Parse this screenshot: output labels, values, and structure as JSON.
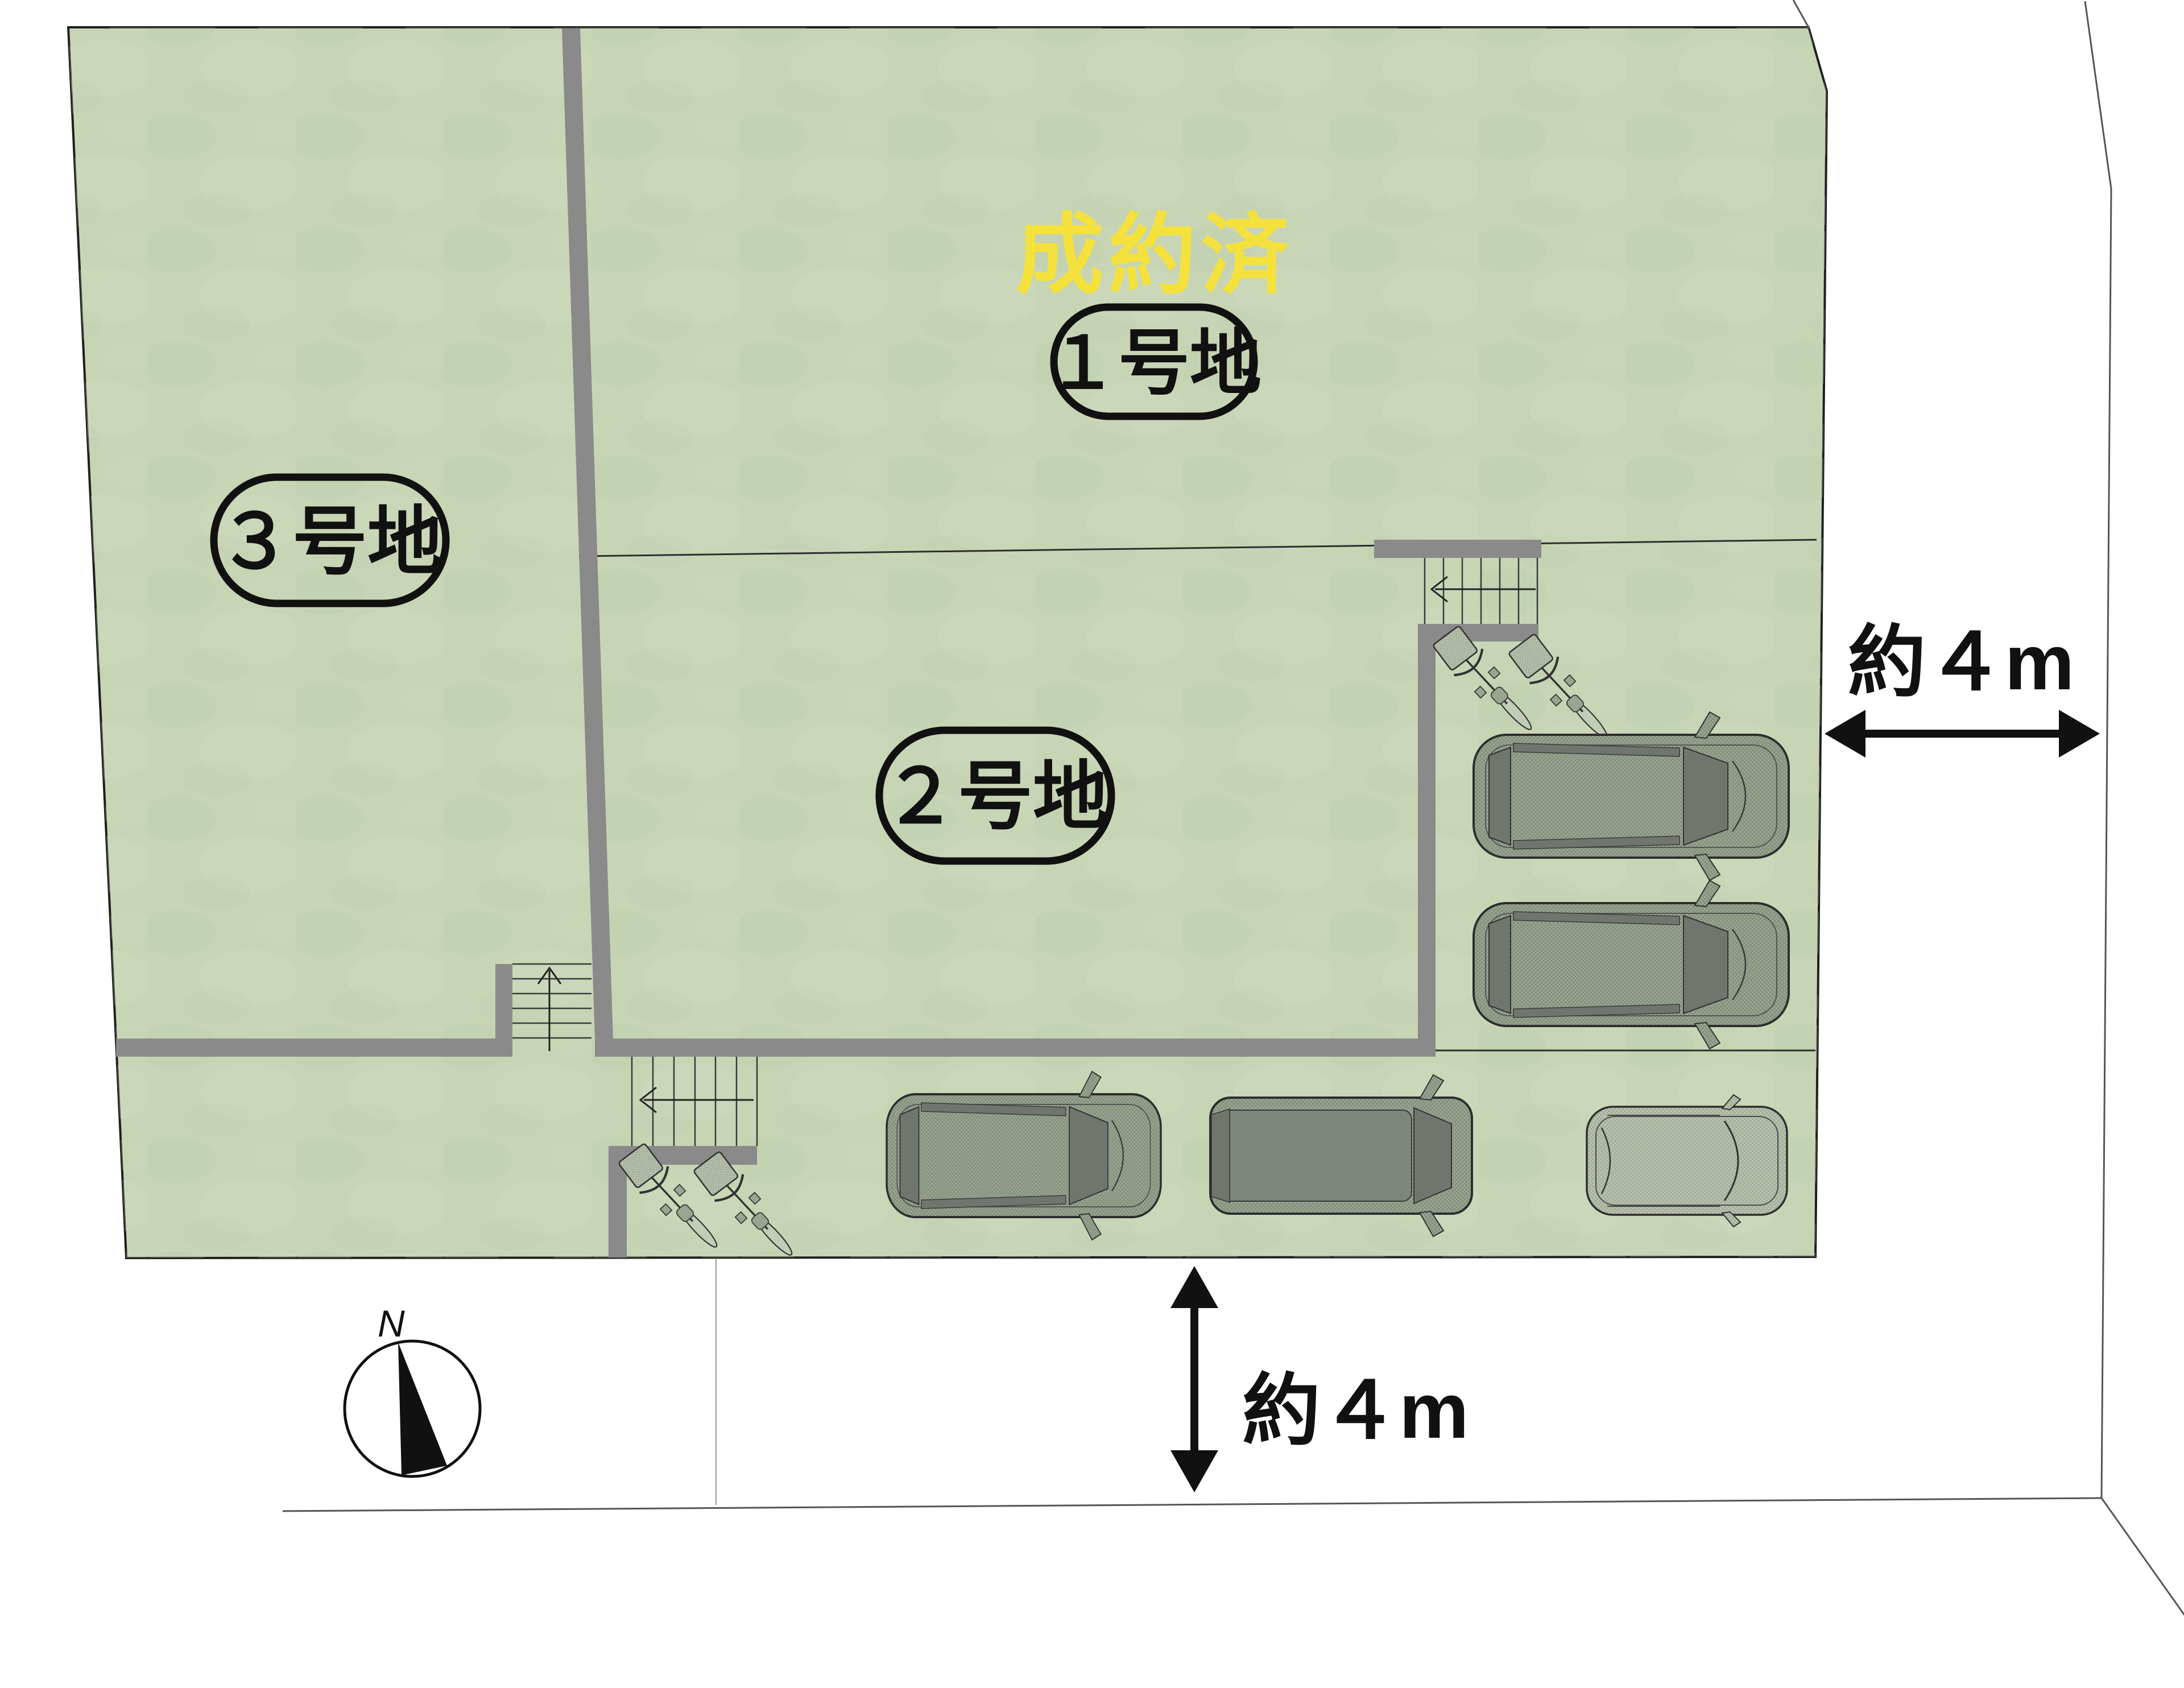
{
  "site_plan": {
    "status_banner": {
      "text": "成約済",
      "color": "#f5e13b"
    },
    "lots": [
      {
        "id": "lot-1",
        "label": "１号地",
        "status": "sold"
      },
      {
        "id": "lot-2",
        "label": "２号地",
        "status": "available"
      },
      {
        "id": "lot-3",
        "label": "３号地",
        "status": "available"
      }
    ],
    "dimensions": {
      "east_road": "約４m",
      "south_road": "約４m"
    },
    "compass": {
      "north_label": "N"
    },
    "colors": {
      "site_fill": "#c7d5b5",
      "wall_gray": "#8a8a8a",
      "outline": "#1f1f1f",
      "road_line": "#555555",
      "banner_yellow": "#f5e13b"
    },
    "features": {
      "cars": 5,
      "bicycles": 4,
      "staircases": 3
    }
  }
}
